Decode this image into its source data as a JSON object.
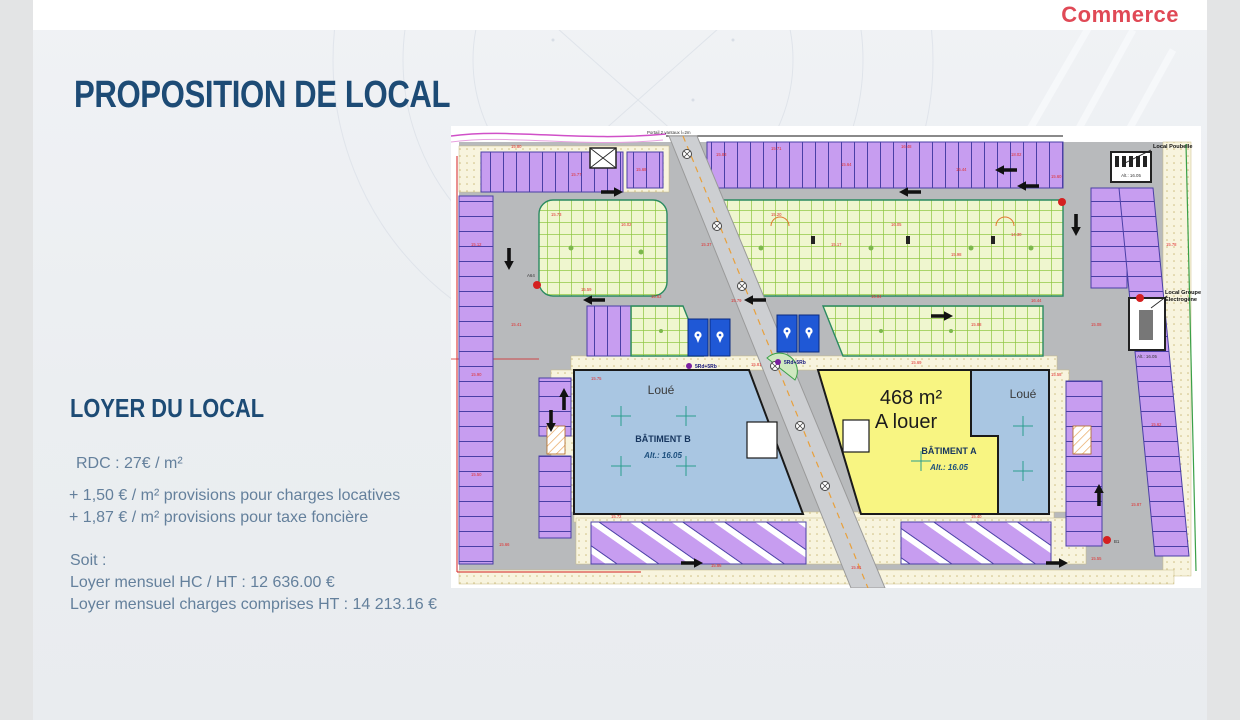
{
  "header": {
    "logo_text": "Commerce"
  },
  "title": "PROPOSITION DE LOCAL",
  "rent": {
    "heading": "LOYER DU LOCAL",
    "rate_line": "RDC : 27€ / m²",
    "charge_lines": [
      "+ 1,50 € / m² provisions pour charges locatives",
      "+ 1,87 € / m² provisions pour taxe foncière"
    ],
    "soit_label": "Soit :",
    "summary_lines": [
      "Loyer mensuel HC / HT : 12 636.00 €",
      "Loyer mensuel charges comprises HT : 14 213.16 €"
    ]
  },
  "plan": {
    "portal_label": "Portail 2 vantaux l=2m",
    "local_poubelle": "Local Poubelle",
    "local_poubelle_alt": "Alt.: 16.05",
    "local_electrogene_l1": "Local Groupe",
    "local_electrogene_l2": "Electrogène",
    "local_electrogene_alt": "Alt.: 16.05",
    "building_b": {
      "name": "BÂTIMENT B",
      "alt": "Alt.: 16.05",
      "status": "Loué"
    },
    "building_a": {
      "name": "BÂTIMENT A",
      "alt": "Alt.: 16.05",
      "area": "468 m²",
      "status": "A louer",
      "status_right": "Loué"
    },
    "bike_label_1": "5Rd+5Rb",
    "bike_label_2": "5Rd+5Rb",
    "marker_b1": "B1",
    "marker_a64": "A64",
    "colors": {
      "parking_purple": "#c79df0",
      "green_band": "#eff6cf",
      "building_blue": "#a9c6e2",
      "available_yellow": "#f8f582",
      "road_gray": "#b8babc",
      "dim_red": "#e03030",
      "accent_logo": "#e04956",
      "title_blue": "#1d4b75"
    },
    "dims": [
      {
        "t": "15.80",
        "x": 60,
        "y": 22
      },
      {
        "t": "15.77",
        "x": 120,
        "y": 50
      },
      {
        "t": "15.68",
        "x": 185,
        "y": 45
      },
      {
        "t": "15.83",
        "x": 265,
        "y": 30
      },
      {
        "t": "15.71",
        "x": 320,
        "y": 24
      },
      {
        "t": "15.64",
        "x": 390,
        "y": 40
      },
      {
        "t": "16.48",
        "x": 450,
        "y": 22
      },
      {
        "t": "15.44",
        "x": 505,
        "y": 45
      },
      {
        "t": "18.02",
        "x": 560,
        "y": 30
      },
      {
        "t": "15.60",
        "x": 600,
        "y": 52
      },
      {
        "t": "15.73",
        "x": 100,
        "y": 90
      },
      {
        "t": "16.02",
        "x": 170,
        "y": 100
      },
      {
        "t": "15.37",
        "x": 250,
        "y": 120
      },
      {
        "t": "15.20",
        "x": 320,
        "y": 90
      },
      {
        "t": "15.17",
        "x": 380,
        "y": 120
      },
      {
        "t": "16.05",
        "x": 440,
        "y": 100
      },
      {
        "t": "15.98",
        "x": 500,
        "y": 130
      },
      {
        "t": "14.30",
        "x": 560,
        "y": 110
      },
      {
        "t": "15.41",
        "x": 60,
        "y": 200
      },
      {
        "t": "15.59",
        "x": 130,
        "y": 165
      },
      {
        "t": "15.63",
        "x": 200,
        "y": 172
      },
      {
        "t": "15.79",
        "x": 280,
        "y": 176
      },
      {
        "t": "15.84",
        "x": 420,
        "y": 172
      },
      {
        "t": "15.88",
        "x": 520,
        "y": 200
      },
      {
        "t": "16.44",
        "x": 580,
        "y": 176
      },
      {
        "t": "15.08",
        "x": 640,
        "y": 200
      },
      {
        "t": "15.12",
        "x": 20,
        "y": 120
      },
      {
        "t": "15.90",
        "x": 20,
        "y": 250
      },
      {
        "t": "15.50",
        "x": 20,
        "y": 350
      },
      {
        "t": "15.66",
        "x": 48,
        "y": 420
      },
      {
        "t": "15.75",
        "x": 140,
        "y": 254
      },
      {
        "t": "15.81",
        "x": 300,
        "y": 240
      },
      {
        "t": "15.69",
        "x": 460,
        "y": 238
      },
      {
        "t": "15.58",
        "x": 600,
        "y": 250
      },
      {
        "t": "15.72",
        "x": 160,
        "y": 392
      },
      {
        "t": "15.86",
        "x": 260,
        "y": 441
      },
      {
        "t": "15.91",
        "x": 400,
        "y": 443
      },
      {
        "t": "15.40",
        "x": 520,
        "y": 392
      },
      {
        "t": "15.55",
        "x": 640,
        "y": 434
      },
      {
        "t": "15.62",
        "x": 700,
        "y": 300
      },
      {
        "t": "15.78",
        "x": 715,
        "y": 120
      },
      {
        "t": "15.87",
        "x": 680,
        "y": 380
      }
    ]
  }
}
